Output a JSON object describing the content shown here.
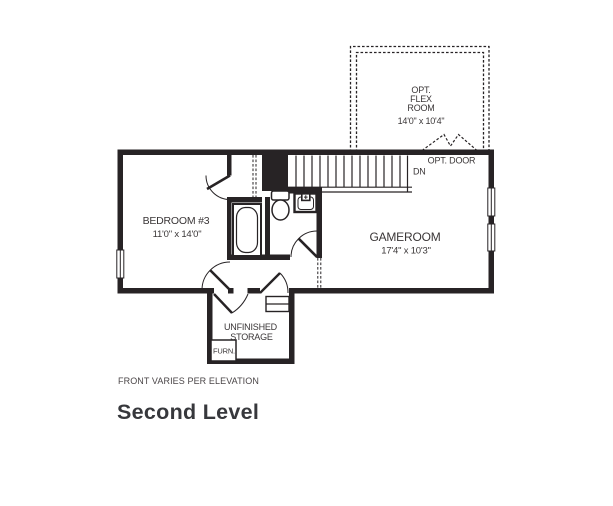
{
  "plan": {
    "flex_room": {
      "label_line1": "OPT.",
      "label_line2": "FLEX",
      "label_line3": "ROOM",
      "dimensions": "14'0\" x 10'4\""
    },
    "opt_door": {
      "label": "OPT. DOOR"
    },
    "stairs": {
      "label": "DN"
    },
    "bedroom3": {
      "name": "BEDROOM #3",
      "dimensions": "11'0\" x 14'0\""
    },
    "gameroom": {
      "name": "GAMEROOM",
      "dimensions": "17'4\" x 10'3\""
    },
    "storage": {
      "name_line1": "UNFINISHED",
      "name_line2": "STORAGE"
    },
    "furnace": {
      "label": "FURN."
    },
    "note": "FRONT VARIES PER ELEVATION"
  },
  "title": "Second Level",
  "colors": {
    "line": "#272325",
    "text": "#3a3637",
    "title": "#37383c"
  }
}
